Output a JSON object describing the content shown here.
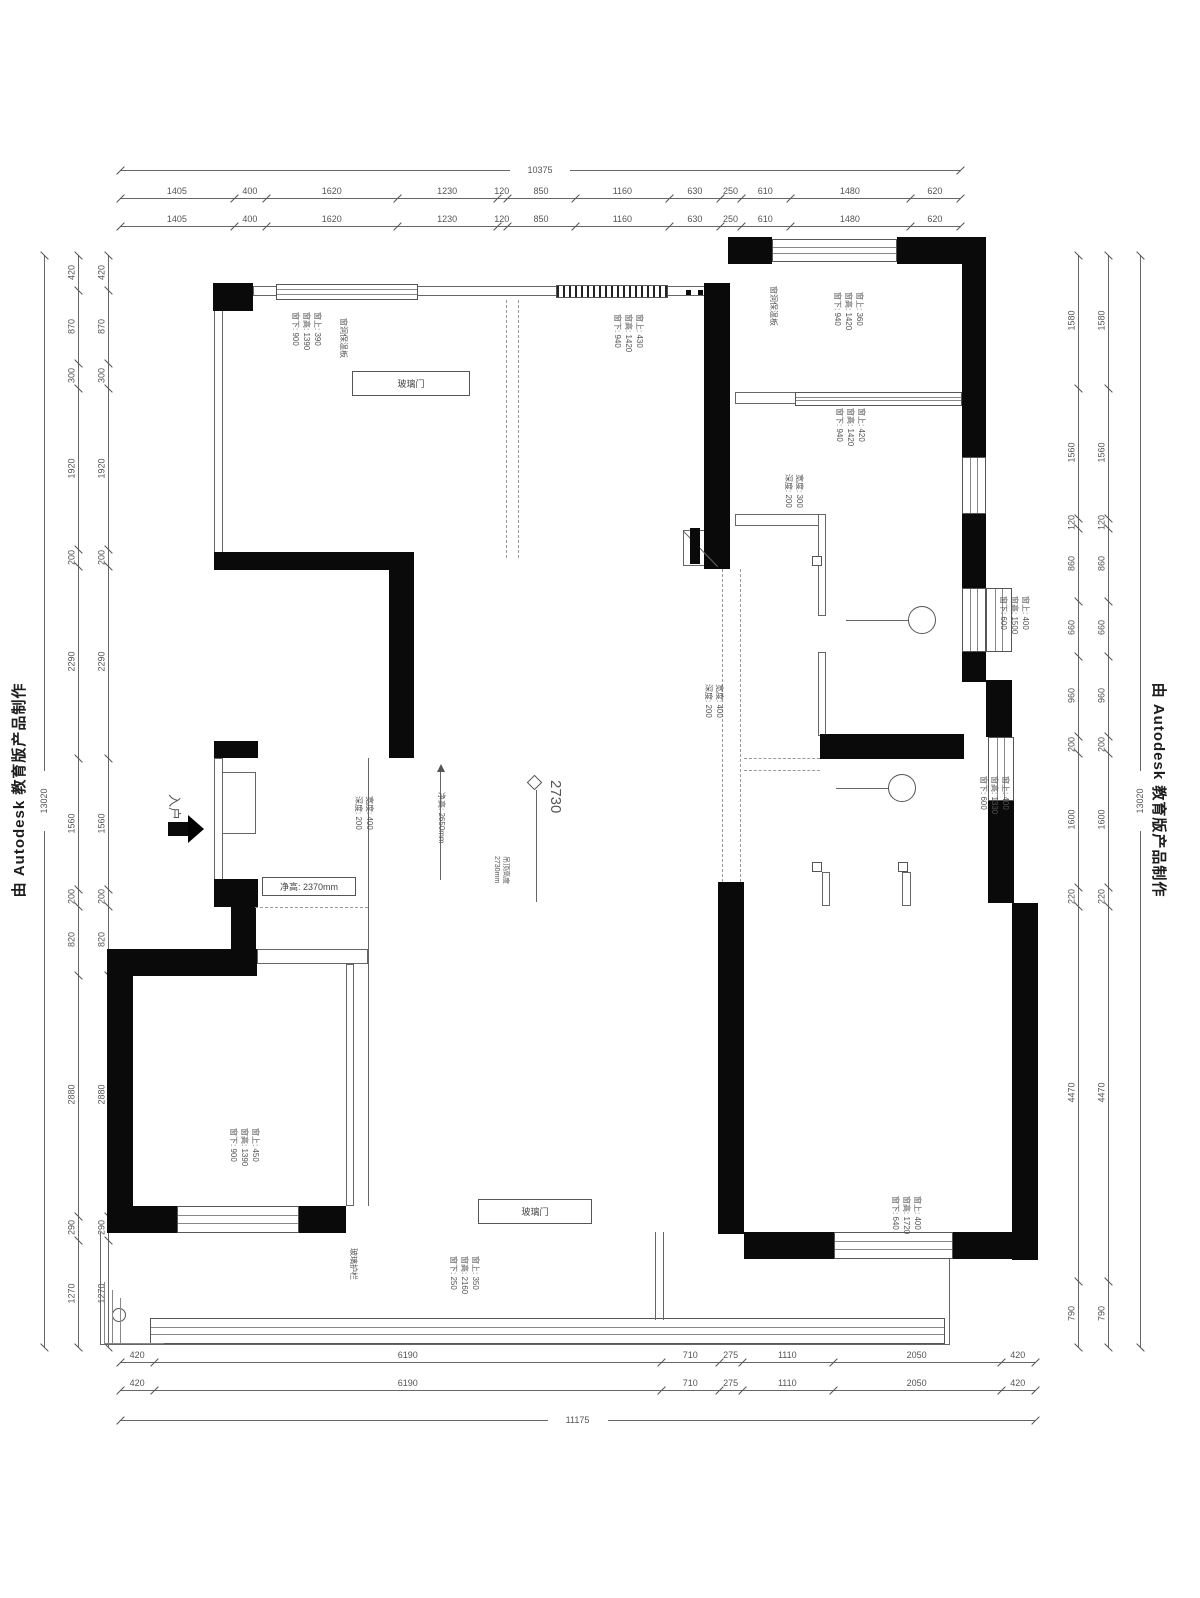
{
  "watermarks": {
    "left": "由 Autodesk 教育版产品制作",
    "right": "由 Autodesk 教育版产品制作"
  },
  "colors": {
    "wall": "#0a0a0a",
    "dim_line": "#666666",
    "dim_text": "#555555",
    "annotation": "#555555"
  },
  "dimensions": {
    "chains": [
      {
        "id": "top-overall",
        "o": "h",
        "x": 120,
        "y": 170,
        "len": 840,
        "overall": true,
        "values": [
          "10375"
        ]
      },
      {
        "id": "top-row-1",
        "o": "h",
        "x": 120,
        "y": 198,
        "len": 840,
        "values": [
          "1405",
          "400",
          "1620",
          "1230",
          "120",
          "850",
          "1160",
          "630",
          "250",
          "610",
          "1480",
          "620"
        ]
      },
      {
        "id": "top-row-2",
        "o": "h",
        "x": 120,
        "y": 226,
        "len": 840,
        "values": [
          "1405",
          "400",
          "1620",
          "1230",
          "120",
          "850",
          "1160",
          "630",
          "250",
          "610",
          "1480",
          "620"
        ]
      },
      {
        "id": "bottom-row-1",
        "o": "h",
        "x": 120,
        "y": 1362,
        "len": 915,
        "values": [
          "420",
          "6190",
          "710",
          "275",
          "1110",
          "2050",
          "420"
        ]
      },
      {
        "id": "bottom-row-2",
        "o": "h",
        "x": 120,
        "y": 1390,
        "len": 915,
        "values": [
          "420",
          "6190",
          "710",
          "275",
          "1110",
          "2050",
          "420"
        ]
      },
      {
        "id": "bottom-overall",
        "o": "h",
        "x": 120,
        "y": 1420,
        "len": 915,
        "overall": true,
        "values": [
          "11175"
        ]
      },
      {
        "id": "left-overall",
        "o": "v",
        "x": 44,
        "y": 255,
        "len": 1092,
        "overall": true,
        "values": [
          "13020"
        ]
      },
      {
        "id": "left-col-outer",
        "o": "v",
        "x": 78,
        "y": 255,
        "len": 1092,
        "values": [
          "420",
          "870",
          "300",
          "1920",
          "200",
          "2290",
          "1560",
          "200",
          "820",
          "2880",
          "290",
          "1270"
        ]
      },
      {
        "id": "left-col-inner",
        "o": "v",
        "x": 108,
        "y": 255,
        "len": 1092,
        "values": [
          "420",
          "870",
          "300",
          "1920",
          "200",
          "2290",
          "1560",
          "200",
          "820",
          "2880",
          "290",
          "1270"
        ]
      },
      {
        "id": "right-col-inner",
        "o": "v",
        "x": 1078,
        "y": 255,
        "len": 1092,
        "values": [
          "1580",
          "1560",
          "120",
          "860",
          "660",
          "960",
          "200",
          "1600",
          "220",
          "4470",
          "790"
        ]
      },
      {
        "id": "right-col-outer",
        "o": "v",
        "x": 1108,
        "y": 255,
        "len": 1092,
        "values": [
          "1580",
          "1560",
          "120",
          "860",
          "660",
          "960",
          "200",
          "1600",
          "220",
          "4470",
          "790"
        ]
      },
      {
        "id": "right-overall",
        "o": "v",
        "x": 1140,
        "y": 255,
        "len": 1092,
        "overall": true,
        "values": [
          "13020"
        ]
      }
    ]
  },
  "plan": {
    "walls": [
      {
        "x": 213,
        "y": 283,
        "w": 40,
        "h": 28
      },
      {
        "x": 704,
        "y": 283,
        "w": 26,
        "h": 286
      },
      {
        "x": 728,
        "y": 237,
        "w": 44,
        "h": 27
      },
      {
        "x": 897,
        "y": 237,
        "w": 89,
        "h": 27
      },
      {
        "x": 962,
        "y": 264,
        "w": 24,
        "h": 193
      },
      {
        "x": 962,
        "y": 514,
        "w": 24,
        "h": 74
      },
      {
        "x": 962,
        "y": 652,
        "w": 24,
        "h": 30
      },
      {
        "x": 986,
        "y": 680,
        "w": 26,
        "h": 57
      },
      {
        "x": 988,
        "y": 801,
        "w": 26,
        "h": 102
      },
      {
        "x": 214,
        "y": 552,
        "w": 200,
        "h": 18
      },
      {
        "x": 389,
        "y": 552,
        "w": 25,
        "h": 206
      },
      {
        "x": 214,
        "y": 741,
        "w": 44,
        "h": 17
      },
      {
        "x": 214,
        "y": 879,
        "w": 44,
        "h": 28
      },
      {
        "x": 231,
        "y": 907,
        "w": 25,
        "h": 46
      },
      {
        "x": 107,
        "y": 949,
        "w": 150,
        "h": 27
      },
      {
        "x": 107,
        "y": 949,
        "w": 26,
        "h": 284
      },
      {
        "x": 107,
        "y": 1206,
        "w": 70,
        "h": 27
      },
      {
        "x": 299,
        "y": 1206,
        "w": 47,
        "h": 27
      },
      {
        "x": 718,
        "y": 882,
        "w": 26,
        "h": 352
      },
      {
        "x": 1012,
        "y": 903,
        "w": 26,
        "h": 357
      },
      {
        "x": 744,
        "y": 1232,
        "w": 90,
        "h": 27
      },
      {
        "x": 953,
        "y": 1232,
        "w": 85,
        "h": 27
      },
      {
        "x": 820,
        "y": 734,
        "w": 144,
        "h": 25
      }
    ],
    "windows": [
      {
        "x": 276,
        "y": 284,
        "w": 142,
        "h": 16,
        "style": "hl"
      },
      {
        "x": 556,
        "y": 285,
        "w": 112,
        "h": 13,
        "style": "dense"
      },
      {
        "x": 772,
        "y": 239,
        "w": 125,
        "h": 23,
        "style": "hl"
      },
      {
        "x": 962,
        "y": 457,
        "w": 24,
        "h": 57,
        "style": "vl"
      },
      {
        "x": 962,
        "y": 588,
        "w": 24,
        "h": 64,
        "style": "vl"
      },
      {
        "x": 986,
        "y": 588,
        "w": 26,
        "h": 64,
        "style": "vl"
      },
      {
        "x": 988,
        "y": 737,
        "w": 26,
        "h": 64,
        "style": "vl"
      },
      {
        "x": 177,
        "y": 1206,
        "w": 122,
        "h": 27,
        "style": "hl"
      },
      {
        "x": 834,
        "y": 1232,
        "w": 119,
        "h": 27,
        "style": "hl"
      },
      {
        "x": 150,
        "y": 1318,
        "w": 795,
        "h": 26,
        "style": "hl"
      },
      {
        "x": 795,
        "y": 392,
        "w": 167,
        "h": 14,
        "style": "hl"
      }
    ],
    "thin_rects": [
      {
        "x": 253,
        "y": 286,
        "w": 452,
        "h": 10
      },
      {
        "x": 214,
        "y": 310,
        "w": 9,
        "h": 243
      },
      {
        "x": 735,
        "y": 392,
        "w": 227,
        "h": 12
      },
      {
        "x": 735,
        "y": 514,
        "w": 85,
        "h": 12
      },
      {
        "x": 818,
        "y": 514,
        "w": 8,
        "h": 102
      },
      {
        "x": 818,
        "y": 652,
        "w": 8,
        "h": 84
      },
      {
        "x": 257,
        "y": 949,
        "w": 111,
        "h": 15
      },
      {
        "x": 346,
        "y": 964,
        "w": 8,
        "h": 242
      },
      {
        "x": 214,
        "y": 758,
        "w": 9,
        "h": 122
      },
      {
        "x": 222,
        "y": 772,
        "w": 34,
        "h": 62
      },
      {
        "x": 902,
        "y": 872,
        "w": 9,
        "h": 34
      },
      {
        "x": 822,
        "y": 872,
        "w": 8,
        "h": 34
      },
      {
        "x": 683,
        "y": 530,
        "w": 34,
        "h": 36
      }
    ],
    "lines": [
      {
        "x": 368,
        "y": 758,
        "w": 1,
        "h": 448
      },
      {
        "x": 846,
        "y": 620,
        "w": 70,
        "h": 1
      },
      {
        "x": 836,
        "y": 788,
        "w": 60,
        "h": 1
      },
      {
        "x": 536,
        "y": 790,
        "w": 1,
        "h": 112
      },
      {
        "x": 440,
        "y": 772,
        "w": 1,
        "h": 108
      },
      {
        "x": 100,
        "y": 1232,
        "w": 1,
        "h": 113
      },
      {
        "x": 100,
        "y": 1344,
        "w": 850,
        "h": 1
      },
      {
        "x": 949,
        "y": 1258,
        "w": 1,
        "h": 87
      },
      {
        "x": 655,
        "y": 1232,
        "w": 1,
        "h": 88
      },
      {
        "x": 663,
        "y": 1232,
        "w": 1,
        "h": 88
      }
    ],
    "dashed": [
      {
        "x": 506,
        "y": 300,
        "len": 258,
        "o": "v"
      },
      {
        "x": 518,
        "y": 300,
        "len": 258,
        "o": "v"
      },
      {
        "x": 722,
        "y": 569,
        "len": 313,
        "o": "v"
      },
      {
        "x": 740,
        "y": 569,
        "len": 313,
        "o": "v"
      },
      {
        "x": 744,
        "y": 758,
        "len": 76,
        "o": "h"
      },
      {
        "x": 744,
        "y": 770,
        "len": 76,
        "o": "h"
      },
      {
        "x": 255,
        "y": 907,
        "len": 113,
        "o": "h"
      }
    ],
    "circles": [
      {
        "x": 908,
        "y": 606,
        "d": 28
      },
      {
        "x": 888,
        "y": 774,
        "d": 28
      },
      {
        "x": 112,
        "y": 1308,
        "d": 14
      }
    ],
    "squares": [
      {
        "x": 812,
        "y": 556,
        "d": 10
      },
      {
        "x": 812,
        "y": 862,
        "d": 10
      },
      {
        "x": 898,
        "y": 862,
        "d": 10
      },
      {
        "x": 686,
        "y": 290,
        "d": 5
      },
      {
        "x": 698,
        "y": 290,
        "d": 5
      }
    ],
    "corners": [
      {
        "x": 104,
        "y": 1282,
        "w": 60,
        "h": 62
      },
      {
        "x": 112,
        "y": 1290,
        "w": 52,
        "h": 54
      },
      {
        "x": 120,
        "y": 1298,
        "w": 44,
        "h": 46
      }
    ],
    "door_boxes": [
      {
        "x": 352,
        "y": 371,
        "w": 118,
        "h": 25,
        "label": "玻璃门"
      },
      {
        "x": 478,
        "y": 1199,
        "w": 114,
        "h": 25,
        "label": "玻璃门"
      },
      {
        "x": 262,
        "y": 877,
        "w": 94,
        "h": 19,
        "label": "净高: 2370mm"
      }
    ],
    "annotations": [
      {
        "x": 286,
        "y": 312,
        "fs": 8,
        "lines": [
          "窗上: 390",
          "窗高: 1390",
          "窗下: 900"
        ]
      },
      {
        "x": 608,
        "y": 314,
        "fs": 8,
        "lines": [
          "窗上: 430",
          "窗高: 1420",
          "窗下: 940"
        ]
      },
      {
        "x": 828,
        "y": 292,
        "fs": 8,
        "lines": [
          "窗上: 360",
          "窗高: 1420",
          "窗下: 940"
        ]
      },
      {
        "x": 830,
        "y": 408,
        "fs": 8,
        "lines": [
          "窗上: 420",
          "窗高: 1420",
          "窗下: 940"
        ]
      },
      {
        "x": 994,
        "y": 596,
        "fs": 8,
        "lines": [
          "窗上: 400",
          "窗高: 1500",
          "窗下: 600"
        ]
      },
      {
        "x": 974,
        "y": 776,
        "fs": 8,
        "lines": [
          "窗上: 400",
          "窗高: 1330",
          "窗下: 600"
        ]
      },
      {
        "x": 224,
        "y": 1128,
        "fs": 8,
        "lines": [
          "窗上: 450",
          "窗高: 1390",
          "窗下: 900"
        ]
      },
      {
        "x": 444,
        "y": 1256,
        "fs": 8,
        "lines": [
          "窗上: 350",
          "窗高: 2160",
          "窗下: 250"
        ]
      },
      {
        "x": 886,
        "y": 1196,
        "fs": 8,
        "lines": [
          "窗上: 400",
          "窗高: 1720",
          "窗下: 640"
        ]
      },
      {
        "x": 350,
        "y": 796,
        "fs": 8,
        "lines": [
          "宽度: 400",
          "深度: 200"
        ]
      },
      {
        "x": 700,
        "y": 684,
        "fs": 8,
        "lines": [
          "宽度: 400",
          "深度: 200"
        ]
      },
      {
        "x": 780,
        "y": 474,
        "fs": 8,
        "lines": [
          "宽度: 300",
          "深度: 200"
        ]
      },
      {
        "x": 336,
        "y": 318,
        "fs": 8,
        "lines": [
          "窗洞保温板"
        ]
      },
      {
        "x": 766,
        "y": 286,
        "fs": 8,
        "lines": [
          "窗洞保温板"
        ]
      },
      {
        "x": 346,
        "y": 1248,
        "fs": 8,
        "lines": [
          "玻璃护栏"
        ]
      },
      {
        "x": 488,
        "y": 856,
        "fs": 7,
        "lines": [
          "吊顶高度",
          "2730mm"
        ]
      },
      {
        "x": 434,
        "y": 792,
        "fs": 8,
        "lines": [
          "净高: 2650mm"
        ]
      },
      {
        "x": 166,
        "y": 794,
        "fs": 13,
        "lines": [
          "入户"
        ]
      },
      {
        "x": 546,
        "y": 780,
        "fs": 15,
        "lines": [
          "2730"
        ]
      }
    ]
  }
}
